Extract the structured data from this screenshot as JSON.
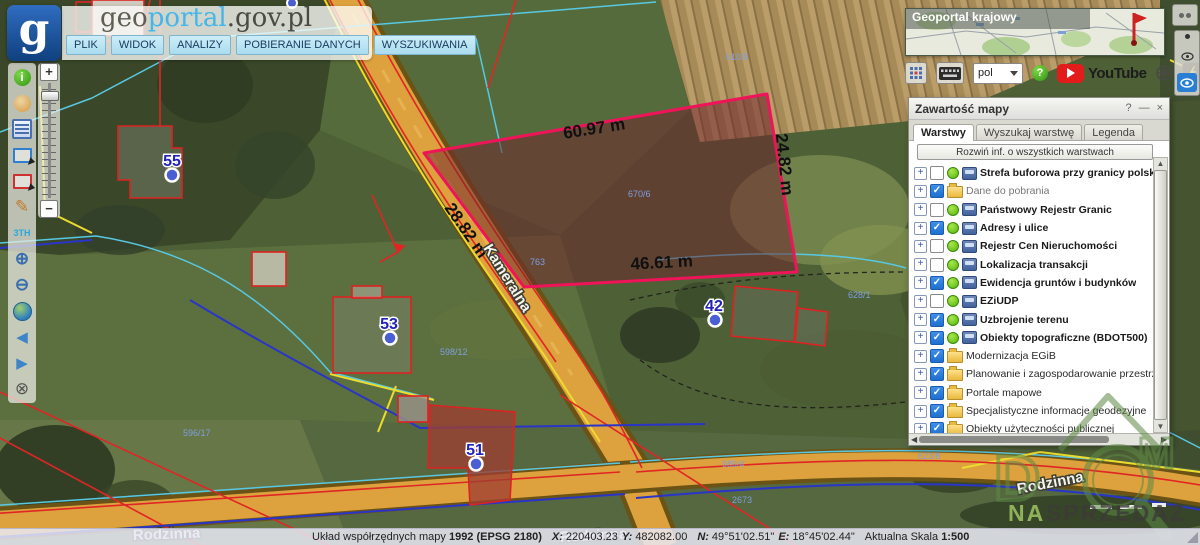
{
  "header": {
    "logo_letter": "g",
    "brand": {
      "part1": "geo",
      "part2": "portal",
      "part3": ".gov.pl"
    },
    "menu": [
      {
        "id": "plik",
        "label": "PLIK"
      },
      {
        "id": "widok",
        "label": "WIDOK"
      },
      {
        "id": "analizy",
        "label": "ANALIZY"
      },
      {
        "id": "pobieranie-danych",
        "label": "POBIERANIE DANYCH"
      },
      {
        "id": "wyszukiwania",
        "label": "WYSZUKIWANIA"
      }
    ]
  },
  "left_toolbar": {
    "icons": [
      "info-icon",
      "history-icon",
      "attribute-form-icon",
      "select-rect-blue-icon",
      "select-rect-red-icon",
      "draw-pencil-icon",
      "measure-icon",
      "zoom-in-icon",
      "zoom-out-icon",
      "globe-extent-icon",
      "previous-view-icon",
      "next-view-icon",
      "clear-selection-icon"
    ],
    "measure_glyph": "3TH",
    "zoom_in_glyph": "⊕",
    "zoom_out_glyph": "⊖",
    "prev_glyph": "◀",
    "next_glyph": "▶",
    "clear_glyph": "⊗",
    "pencil_glyph": "✎",
    "info_glyph": "i"
  },
  "zoom_slider": {
    "plus": "+",
    "minus": "−"
  },
  "minimap": {
    "title": "Geoportal krajowy"
  },
  "topbar": {
    "language": "pol",
    "youtube_label": "YouTube",
    "help_glyph": "?"
  },
  "map": {
    "measurements": {
      "top": "60.97 m",
      "right": "24.82 m",
      "left": "28.82 m",
      "bottom": "46.61 m"
    },
    "streets": {
      "kameralna": "Kameralna",
      "rodzinna": "Rodzinna"
    },
    "address_points": [
      {
        "label": "55"
      },
      {
        "label": "53"
      },
      {
        "label": "51"
      },
      {
        "label": "42"
      }
    ],
    "parcel_labels": [
      "670/6",
      "763",
      "596/17",
      "598/12",
      "989/4",
      "623/8",
      "628/1",
      "610/5",
      "2673"
    ],
    "colors": {
      "parcel_stroke": "#ef1459",
      "parcel_fill": "rgba(112,36,46,0.52)",
      "road": "#dda23d",
      "address_marker": "#4a5fd4"
    }
  },
  "layers_panel": {
    "title": "Zawartość mapy",
    "window_buttons": {
      "help": "?",
      "minimize": "—",
      "close": "×"
    },
    "tabs": [
      {
        "label": "Warstwy",
        "active": true
      },
      {
        "label": "Wyszukaj warstwę",
        "active": false
      },
      {
        "label": "Legenda",
        "active": false
      }
    ],
    "expand_all_label": "Rozwiń inf. o wszystkich warstwach",
    "layers": [
      {
        "label": "Strefa buforowa przy granicy polsko-białoruskiej",
        "checked": false,
        "kind": "wms",
        "bold": true
      },
      {
        "label": "Dane do pobrania",
        "checked": true,
        "kind": "folder",
        "bold": false,
        "muted": true
      },
      {
        "label": "Państwowy Rejestr Granic",
        "checked": false,
        "kind": "wms",
        "bold": true
      },
      {
        "label": "Adresy i ulice",
        "checked": true,
        "kind": "wms",
        "bold": true
      },
      {
        "label": "Rejestr Cen Nieruchomości",
        "checked": false,
        "kind": "wms",
        "bold": true
      },
      {
        "label": "Lokalizacja transakcji",
        "checked": false,
        "kind": "wms",
        "bold": true
      },
      {
        "label": "Ewidencja gruntów i budynków",
        "checked": true,
        "kind": "wms",
        "bold": true
      },
      {
        "label": "EZiUDP",
        "checked": false,
        "kind": "wms",
        "bold": true
      },
      {
        "label": "Uzbrojenie terenu",
        "checked": true,
        "kind": "wms",
        "bold": true
      },
      {
        "label": "Obiekty topograficzne (BDOT500)",
        "checked": true,
        "kind": "wms",
        "bold": true
      },
      {
        "label": "Modernizacja EGiB",
        "checked": true,
        "kind": "folder",
        "bold": false
      },
      {
        "label": "Planowanie i zagospodarowanie przestrzenne",
        "checked": true,
        "kind": "folder",
        "bold": false
      },
      {
        "label": "Portale mapowe",
        "checked": true,
        "kind": "folder",
        "bold": false
      },
      {
        "label": "Specjalistyczne informacje geodezyjne",
        "checked": true,
        "kind": "folder",
        "bold": false
      },
      {
        "label": "Obiekty użyteczności publicznej",
        "checked": true,
        "kind": "folder",
        "bold": false
      }
    ]
  },
  "status_bar": {
    "crs_label": "Układ współrzędnych mapy",
    "crs_value": "1992 (EPSG 2180)",
    "x_label": "X:",
    "x_value": "220403.23",
    "y_label": "Y:",
    "y_value": "482082.00",
    "n_label": "N:",
    "n_value": "49°51'02.51\"",
    "e_label": "E:",
    "e_value": "18°45'02.44\"",
    "scale_label": "Aktualna Skala",
    "scale_value": "1:500"
  },
  "watermark": {
    "letter_d": "D",
    "letter_m": "M",
    "line2_green": "NA",
    "line2_dark": "SPRZEDAZ"
  }
}
